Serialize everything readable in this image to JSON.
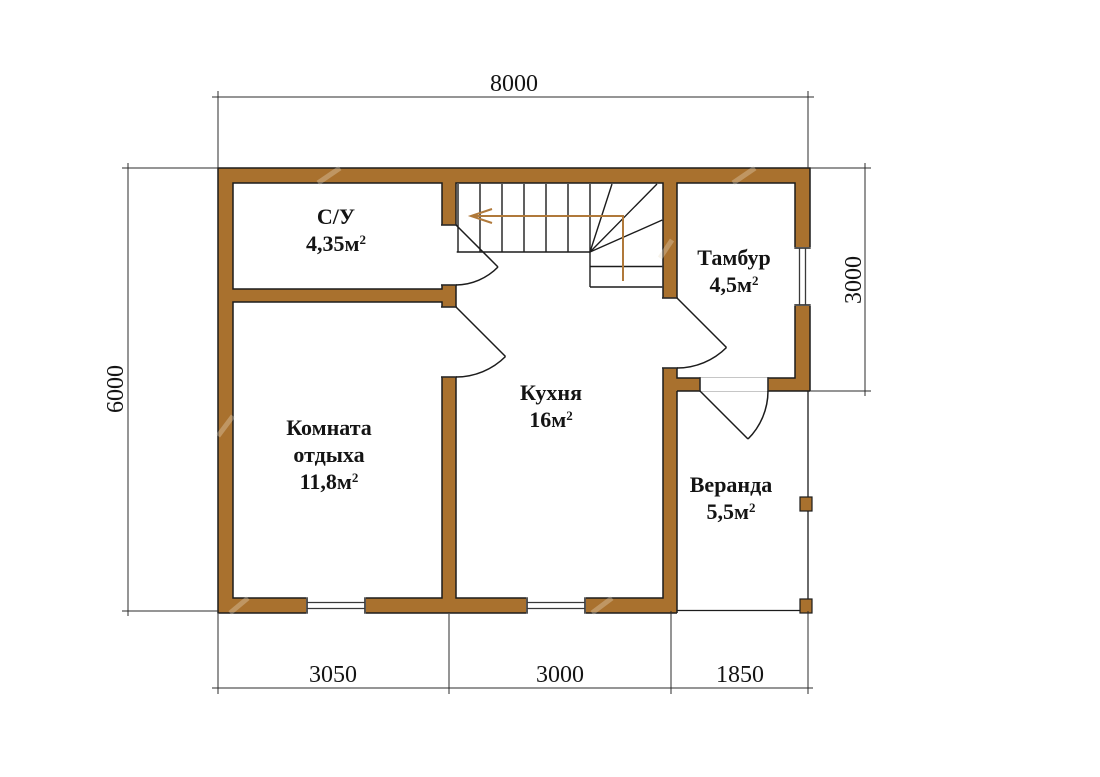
{
  "colors": {
    "background": "#ffffff",
    "wall_fill": "#a9712e",
    "line": "#1c1c1c",
    "dimension_line": "#2b2b2b",
    "stair_arrow": "#b0793a"
  },
  "rooms": [
    {
      "name": "С/У",
      "area": "4,35м",
      "area_sup": "2"
    },
    {
      "name": "Комната отдыха",
      "area": "11,8м",
      "area_sup": "2"
    },
    {
      "name": "Кухня",
      "area": "16м",
      "area_sup": "2"
    },
    {
      "name": "Тамбур",
      "area": "4,5м",
      "area_sup": "2"
    },
    {
      "name": "Веранда",
      "area": "5,5м",
      "area_sup": "2"
    }
  ],
  "dimensions": {
    "top": "8000",
    "left": "6000",
    "right": "3000",
    "bottom_left": "3050",
    "bottom_middle": "3000",
    "bottom_right": "1850"
  }
}
